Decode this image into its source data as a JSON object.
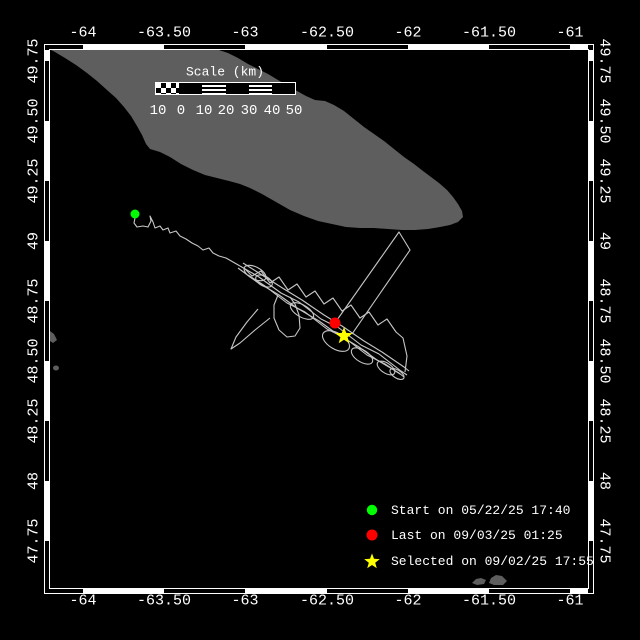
{
  "colors": {
    "background": "#000000",
    "land": "#5e5e5e",
    "track": "#c6c6c6",
    "frame": "#ffffff",
    "text": "#ffffff",
    "start_marker": "#00ff00",
    "last_marker": "#ff0000",
    "selected_marker": "#ffff00"
  },
  "frame": {
    "x_ticks": [
      {
        "label": "-64",
        "px": 83
      },
      {
        "label": "-63.50",
        "px": 164
      },
      {
        "label": "-63",
        "px": 245
      },
      {
        "label": "-62.50",
        "px": 327
      },
      {
        "label": "-62",
        "px": 408
      },
      {
        "label": "-61.50",
        "px": 489
      },
      {
        "label": "-61",
        "px": 570
      }
    ],
    "y_ticks": [
      {
        "label": "49.75",
        "px": 61
      },
      {
        "label": "49.50",
        "px": 121
      },
      {
        "label": "49.25",
        "px": 181
      },
      {
        "label": "49",
        "px": 241
      },
      {
        "label": "48.75",
        "px": 301
      },
      {
        "label": "48.50",
        "px": 361
      },
      {
        "label": "48.25",
        "px": 421
      },
      {
        "label": "48",
        "px": 481
      },
      {
        "label": "47.75",
        "px": 541
      }
    ]
  },
  "scale_bar": {
    "title": "Scale (km)",
    "ticks": [
      {
        "label": "10",
        "px": 158
      },
      {
        "label": "0",
        "px": 181
      },
      {
        "label": "10",
        "px": 204
      },
      {
        "label": "20",
        "px": 226
      },
      {
        "label": "30",
        "px": 249
      },
      {
        "label": "40",
        "px": 272
      },
      {
        "label": "50",
        "px": 294
      }
    ]
  },
  "legend": {
    "items": [
      {
        "marker": "start-dot",
        "label": "Start on 05/22/25 17:40",
        "row_y": 510
      },
      {
        "marker": "last-dot",
        "label": "Last on 09/03/25 01:25",
        "row_y": 535
      },
      {
        "marker": "selected-star",
        "label": "Selected on 09/02/25 17:55",
        "row_y": 561
      }
    ]
  },
  "map": {
    "island": [
      [
        51,
        50
      ],
      [
        219,
        50
      ],
      [
        228,
        53
      ],
      [
        238,
        58
      ],
      [
        248,
        64
      ],
      [
        258,
        69
      ],
      [
        268,
        74
      ],
      [
        278,
        80
      ],
      [
        288,
        86
      ],
      [
        297,
        91
      ],
      [
        306,
        96
      ],
      [
        315,
        100
      ],
      [
        325,
        101
      ],
      [
        334,
        105
      ],
      [
        344,
        111
      ],
      [
        354,
        119
      ],
      [
        364,
        127
      ],
      [
        374,
        134
      ],
      [
        384,
        141
      ],
      [
        394,
        149
      ],
      [
        404,
        157
      ],
      [
        414,
        164
      ],
      [
        423,
        171
      ],
      [
        431,
        177
      ],
      [
        439,
        183
      ],
      [
        447,
        190
      ],
      [
        453,
        197
      ],
      [
        458,
        204
      ],
      [
        462,
        211
      ],
      [
        463,
        217
      ],
      [
        458,
        222
      ],
      [
        450,
        225
      ],
      [
        440,
        227
      ],
      [
        428,
        229
      ],
      [
        415,
        230
      ],
      [
        402,
        230
      ],
      [
        388,
        229
      ],
      [
        374,
        228
      ],
      [
        360,
        228
      ],
      [
        346,
        227
      ],
      [
        332,
        224
      ],
      [
        318,
        221
      ],
      [
        304,
        216
      ],
      [
        290,
        210
      ],
      [
        276,
        202
      ],
      [
        262,
        194
      ],
      [
        250,
        188
      ],
      [
        240,
        184
      ],
      [
        229,
        181
      ],
      [
        217,
        178
      ],
      [
        205,
        175
      ],
      [
        193,
        170
      ],
      [
        181,
        164
      ],
      [
        170,
        157
      ],
      [
        160,
        152
      ],
      [
        150,
        149
      ],
      [
        146,
        144
      ],
      [
        142,
        135
      ],
      [
        137,
        126
      ],
      [
        131,
        116
      ],
      [
        124,
        107
      ],
      [
        116,
        98
      ],
      [
        107,
        90
      ],
      [
        97,
        81
      ],
      [
        87,
        73
      ],
      [
        76,
        65
      ],
      [
        65,
        58
      ],
      [
        55,
        52
      ]
    ],
    "islets": [
      [
        [
          472,
          583
        ],
        [
          476,
          579
        ],
        [
          481,
          578
        ],
        [
          486,
          580
        ],
        [
          484,
          584
        ],
        [
          477,
          585
        ]
      ],
      [
        [
          489,
          583
        ],
        [
          491,
          578
        ],
        [
          496,
          575
        ],
        [
          502,
          576
        ],
        [
          507,
          581
        ],
        [
          503,
          585
        ],
        [
          494,
          585
        ]
      ],
      [
        [
          50,
          331
        ],
        [
          54,
          334
        ],
        [
          57,
          340
        ],
        [
          53,
          343
        ],
        [
          50,
          341
        ]
      ]
    ],
    "small_islet_dot": {
      "cx": 56,
      "cy": 368,
      "rx": 3,
      "ry": 2.5
    },
    "track": {
      "paths": [
        [
          [
            135,
            218
          ],
          [
            134,
            223
          ],
          [
            137,
            227
          ],
          [
            143,
            226
          ],
          [
            148,
            227
          ],
          [
            151,
            221
          ],
          [
            150,
            216
          ],
          [
            153,
            222
          ],
          [
            155,
            228
          ],
          [
            160,
            226
          ],
          [
            163,
            230
          ],
          [
            168,
            228
          ],
          [
            170,
            233
          ],
          [
            176,
            231
          ],
          [
            180,
            236
          ],
          [
            186,
            239
          ],
          [
            192,
            243
          ],
          [
            198,
            246
          ],
          [
            203,
            250
          ],
          [
            209,
            248
          ],
          [
            213,
            253
          ],
          [
            219,
            256
          ],
          [
            226,
            258
          ],
          [
            233,
            262
          ],
          [
            240,
            266
          ]
        ],
        [
          [
            240,
            266
          ],
          [
            259,
            277
          ],
          [
            281,
            293
          ],
          [
            299,
            302
          ],
          [
            321,
            319
          ],
          [
            339,
            328
          ],
          [
            361,
            345
          ],
          [
            379,
            354
          ],
          [
            401,
            371
          ],
          [
            407,
            375
          ]
        ],
        [
          [
            238,
            268
          ],
          [
            257,
            282
          ],
          [
            279,
            295
          ],
          [
            297,
            308
          ],
          [
            319,
            321
          ],
          [
            337,
            334
          ],
          [
            359,
            347
          ],
          [
            377,
            360
          ],
          [
            399,
            373
          ],
          [
            404,
            377
          ]
        ],
        [
          [
            243,
            263
          ],
          [
            262,
            275
          ],
          [
            284,
            289
          ],
          [
            302,
            300
          ],
          [
            324,
            315
          ],
          [
            342,
            326
          ],
          [
            364,
            341
          ],
          [
            382,
            352
          ],
          [
            404,
            367
          ],
          [
            409,
            371
          ]
        ],
        [
          [
            244,
            268
          ],
          [
            252,
            276
          ],
          [
            261,
            271
          ],
          [
            270,
            283
          ],
          [
            279,
            277
          ],
          [
            288,
            290
          ],
          [
            297,
            284
          ],
          [
            306,
            297
          ],
          [
            315,
            291
          ],
          [
            324,
            304
          ],
          [
            333,
            298
          ],
          [
            342,
            311
          ],
          [
            351,
            305
          ],
          [
            360,
            318
          ],
          [
            369,
            312
          ],
          [
            378,
            325
          ],
          [
            387,
            319
          ],
          [
            396,
            332
          ],
          [
            403,
            338
          ],
          [
            407,
            356
          ],
          [
            405,
            372
          ]
        ],
        [
          [
            248,
            275
          ],
          [
            265,
            286
          ],
          [
            287,
            303
          ],
          [
            305,
            312
          ],
          [
            327,
            329
          ],
          [
            345,
            338
          ],
          [
            367,
            355
          ],
          [
            385,
            364
          ],
          [
            400,
            374
          ]
        ],
        [
          [
            278,
            295
          ],
          [
            274,
            305
          ],
          [
            274,
            318
          ],
          [
            279,
            330
          ],
          [
            287,
            337
          ],
          [
            295,
            336
          ],
          [
            300,
            328
          ],
          [
            299,
            315
          ],
          [
            295,
            304
          ],
          [
            290,
            297
          ]
        ],
        [
          [
            270,
            318
          ],
          [
            255,
            330
          ],
          [
            240,
            343
          ],
          [
            231,
            349
          ],
          [
            236,
            337
          ],
          [
            247,
            322
          ],
          [
            258,
            309
          ]
        ],
        [
          [
            337,
            320
          ],
          [
            399,
            232
          ],
          [
            410,
            250
          ],
          [
            352,
            334
          ]
        ]
      ],
      "loops": [
        {
          "cx": 255,
          "cy": 273,
          "rx": 12,
          "ry": 6,
          "rot": 28
        },
        {
          "cx": 264,
          "cy": 281,
          "rx": 9,
          "ry": 5,
          "rot": 28
        },
        {
          "cx": 302,
          "cy": 311,
          "rx": 13,
          "ry": 6,
          "rot": 30
        },
        {
          "cx": 336,
          "cy": 341,
          "rx": 15,
          "ry": 8,
          "rot": 31
        },
        {
          "cx": 362,
          "cy": 356,
          "rx": 12,
          "ry": 6,
          "rot": 32
        },
        {
          "cx": 386,
          "cy": 368,
          "rx": 10,
          "ry": 5,
          "rot": 33
        },
        {
          "cx": 397,
          "cy": 374,
          "rx": 8,
          "ry": 4,
          "rot": 33
        }
      ]
    },
    "markers": {
      "start": {
        "x": 135,
        "y": 214,
        "r": 4.5
      },
      "last": {
        "x": 335,
        "y": 323,
        "r": 5.5
      },
      "selected": {
        "x": 344,
        "y": 336,
        "outer": 9,
        "inner": 3.8
      }
    }
  }
}
